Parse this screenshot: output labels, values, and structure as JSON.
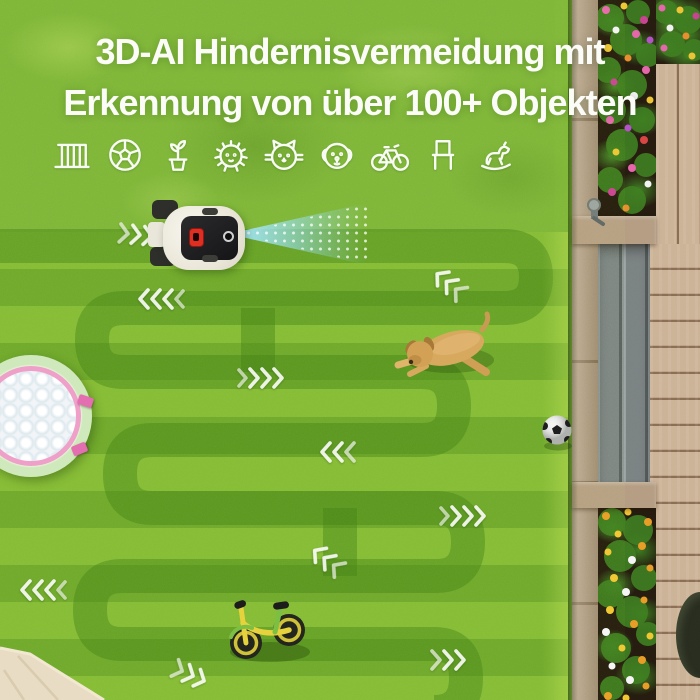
{
  "headline": {
    "line1": "3D-AI Hindernisvermeidung mit",
    "line2": "Erkennung von über 100+ Objekten"
  },
  "icons": [
    "fence",
    "soccer-ball",
    "potted-plant",
    "hedgehog",
    "cat",
    "dog",
    "bicycle",
    "chair",
    "rocking-horse"
  ],
  "scene": {
    "objects": [
      "robot-mower",
      "3d-vision-beam",
      "kiddie-pool",
      "lying-dog",
      "soccer-ball",
      "balance-bike",
      "parasol-corner",
      "flower-bed-top",
      "flower-bed-bottom",
      "wooden-deck",
      "garden-tap",
      "mowing-direction-arrows"
    ]
  },
  "colors": {
    "grass_light": "#84ba37",
    "grass_dark": "#6ea72d",
    "mow_path": "#3f7d15",
    "beam_blue": "#96def6",
    "headline_text": "#fbfcf7",
    "deck_wood": "#cbb298",
    "pool_pink": "#efa0c8",
    "bike_yellow": "#e6d23c"
  }
}
